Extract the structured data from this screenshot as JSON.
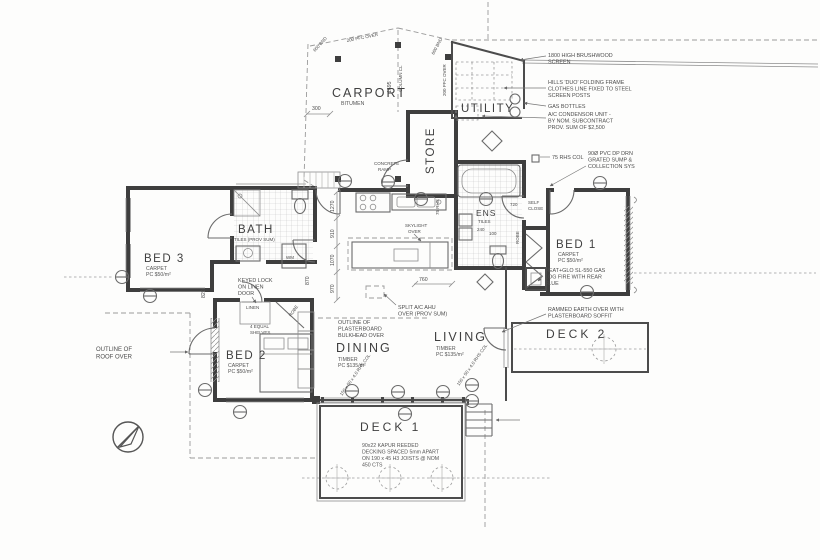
{
  "rooms": {
    "carport": {
      "label": "CARPORT",
      "finish": "BITUMEN"
    },
    "utility": {
      "label": "UTILITY"
    },
    "store": {
      "label": "STORE"
    },
    "bath": {
      "label": "BATH",
      "finish": "TILES (PROV SUM)"
    },
    "ens": {
      "label": "ENS",
      "finish": "TILES"
    },
    "bed1": {
      "label": "BED 1",
      "finish": "CARPET",
      "rate": "PC $50/m²"
    },
    "bed2": {
      "label": "BED 2",
      "finish": "CARPET",
      "rate": "PC $50/m²"
    },
    "bed3": {
      "label": "BED 3",
      "finish": "CARPET",
      "rate": "PC $50/m²"
    },
    "dining": {
      "label": "DINING",
      "finish": "TIMBER",
      "rate": "PC $135/m²"
    },
    "living": {
      "label": "LIVING",
      "finish": "TIMBER",
      "rate": "PC $135/m²"
    },
    "deck1": {
      "label": "DECK 1"
    },
    "deck2": {
      "label": "DECK 2"
    },
    "linen": {
      "label": "LINEN"
    },
    "robe_hall": {
      "label": "ROBE"
    },
    "robe_bed1": {
      "label": "ROBE"
    },
    "wm": {
      "label": "WM"
    }
  },
  "annotations": {
    "brushwood": [
      "1800 HIGH BRUSHWOOD",
      "SCREEN"
    ],
    "clothesline": [
      "HILLS 'DUO' FOLDING FRAME",
      "CLOTHES LINE FIXED TO STEEL",
      "SCREEN POSTS"
    ],
    "gas_bottles": "GAS BOTTLES",
    "ac_unit": [
      "A/C CONDENSOR UNIT -",
      "BY NOM. SUBCONTRACT",
      "PROV. SUM OF $2,500"
    ],
    "rhs_col": "75 RHS COL",
    "pvc_dp": [
      "90Ø PVC DP DRN",
      "GRATED SUMP &",
      "COLLECTION SYS"
    ],
    "heatglo": [
      "HEAT+GLO SL-550 GAS",
      "LOG FIRE WITH REAR",
      "FLUE"
    ],
    "self_close": [
      "SELF",
      "CLOSE"
    ],
    "rammed_earth": [
      "RAMMED EARTH OVER WITH",
      "PLASTERBOARD SOFFIT"
    ],
    "split_ac": [
      "SPLIT A/C AHU",
      "OVER (PROV SUM)"
    ],
    "bulkhead": [
      "OUTLINE OF",
      "PLASTERBOARD",
      "BULKHEAD OVER"
    ],
    "roof_outline": [
      "OUTLINE OF",
      "ROOF OVER"
    ],
    "decking": [
      "90x22 KAPUR REEDED",
      "DECKING SPACED 5mm APART",
      "ON 190 x 45 H3 JOISTS @ NOM",
      "450 CTS"
    ],
    "keyed_lock": [
      "KEYED LOCK",
      "ON LINEN",
      "DOOR"
    ],
    "shelves": [
      "4 EQUAL",
      "SHELVES"
    ],
    "concrete_ramp": [
      "CONCRETE",
      "RAMP"
    ],
    "skylight": [
      "SKYLIGHT",
      "OVER"
    ],
    "column_cl": "COLUMN CL",
    "pfc_over": "200 PFC OVER",
    "bnd": "600 BND",
    "rhs_75": "75 RHS",
    "rhs_150": "150 x 50 x 4.0 RHS COL"
  },
  "dimensions": {
    "d300": "300",
    "d1695": "1695",
    "d760": "760",
    "d1270": "1270",
    "d910": "910",
    "d1070": "1070",
    "d970": "970",
    "d870": "870",
    "d820": "820",
    "d720": "720",
    "d240": "240",
    "d100": "100"
  }
}
